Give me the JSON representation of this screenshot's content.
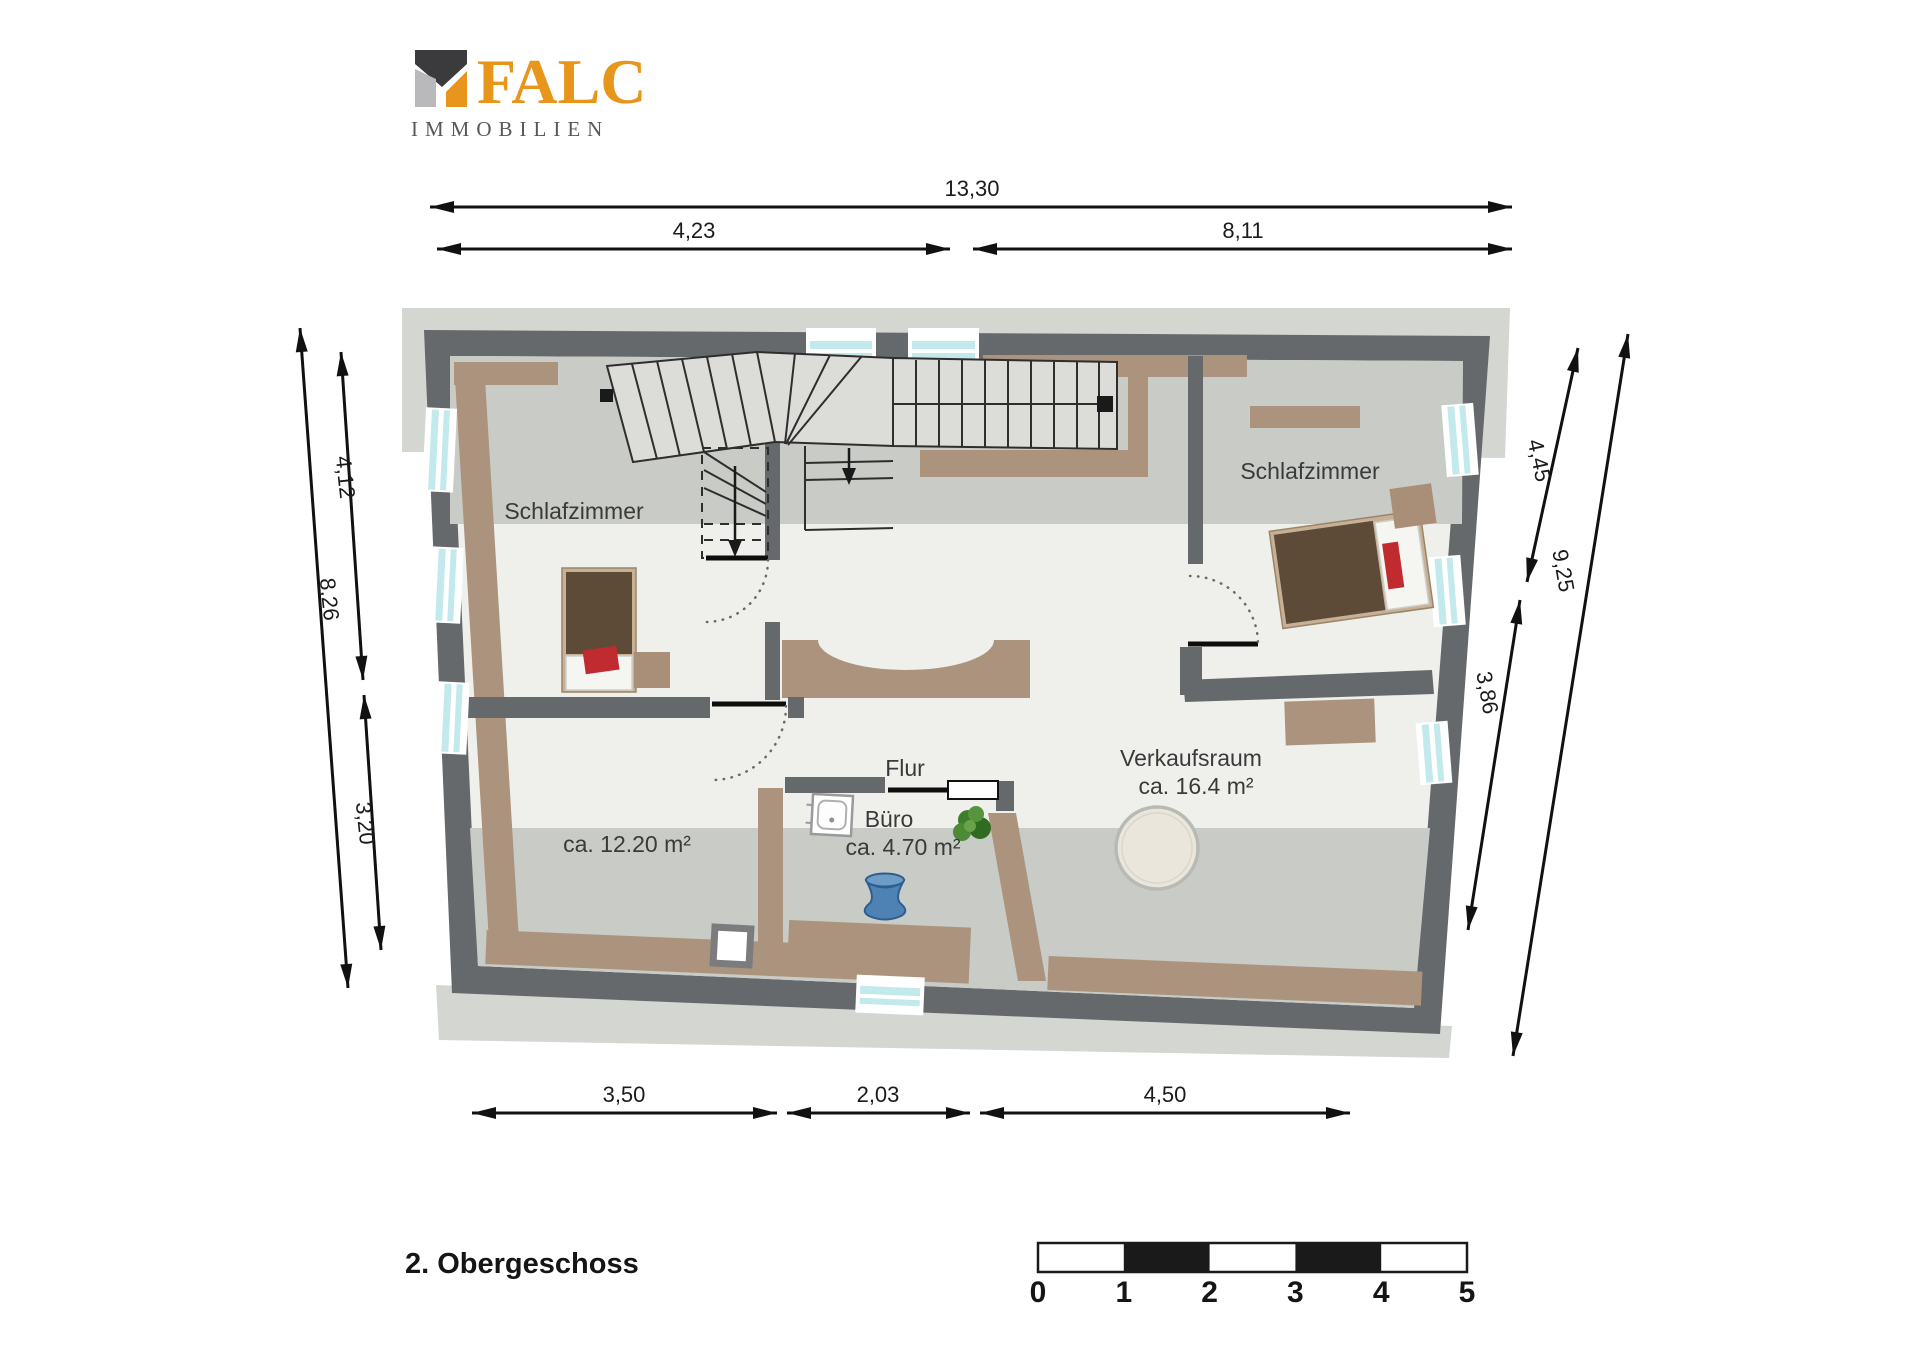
{
  "logo": {
    "brand": "FALC",
    "subtitle": "IMMOBILIEN"
  },
  "floor_label": "2. Obergeschoss",
  "rooms": {
    "bedroom_left": {
      "name": "Schlafzimmer",
      "area": "ca. 12.20 m²"
    },
    "bedroom_right": {
      "name": "Schlafzimmer"
    },
    "hall": {
      "name": "Flur"
    },
    "office": {
      "name": "Büro",
      "area": "ca. 4.70 m²"
    },
    "sales_room": {
      "name": "Verkaufsraum",
      "area": "ca. 16.4 m²"
    }
  },
  "dimensions_m": {
    "top_total": "13,30",
    "top_left": "4,23",
    "top_right": "8,11",
    "left_upper": "4,12",
    "left_lower": "3,20",
    "left_total": "8,26",
    "right_upper": "4,45",
    "right_lower": "3,86",
    "right_total": "9,25",
    "bottom_left": "3,50",
    "bottom_middle": "2,03",
    "bottom_right": "4,50"
  },
  "scale_bar": {
    "ticks": [
      "0",
      "1",
      "2",
      "3",
      "4",
      "5"
    ]
  },
  "colors": {
    "brand_orange": "#E8951C",
    "logo_dark": "#3b3b3d",
    "logo_light": "#b9b9bb",
    "wall_gray": "#65696c",
    "floor": "#eff0ec",
    "shade_band": "#c9cbc7",
    "outer_band": "#d4d6d2",
    "wood": "#ac937d",
    "window_glass": "#c2e9ec",
    "bed_brown": "#5d4a37",
    "accent_red": "#bf2b2f",
    "plant_green": "#3e7d2b",
    "vase_blue": "#4e82b4"
  }
}
